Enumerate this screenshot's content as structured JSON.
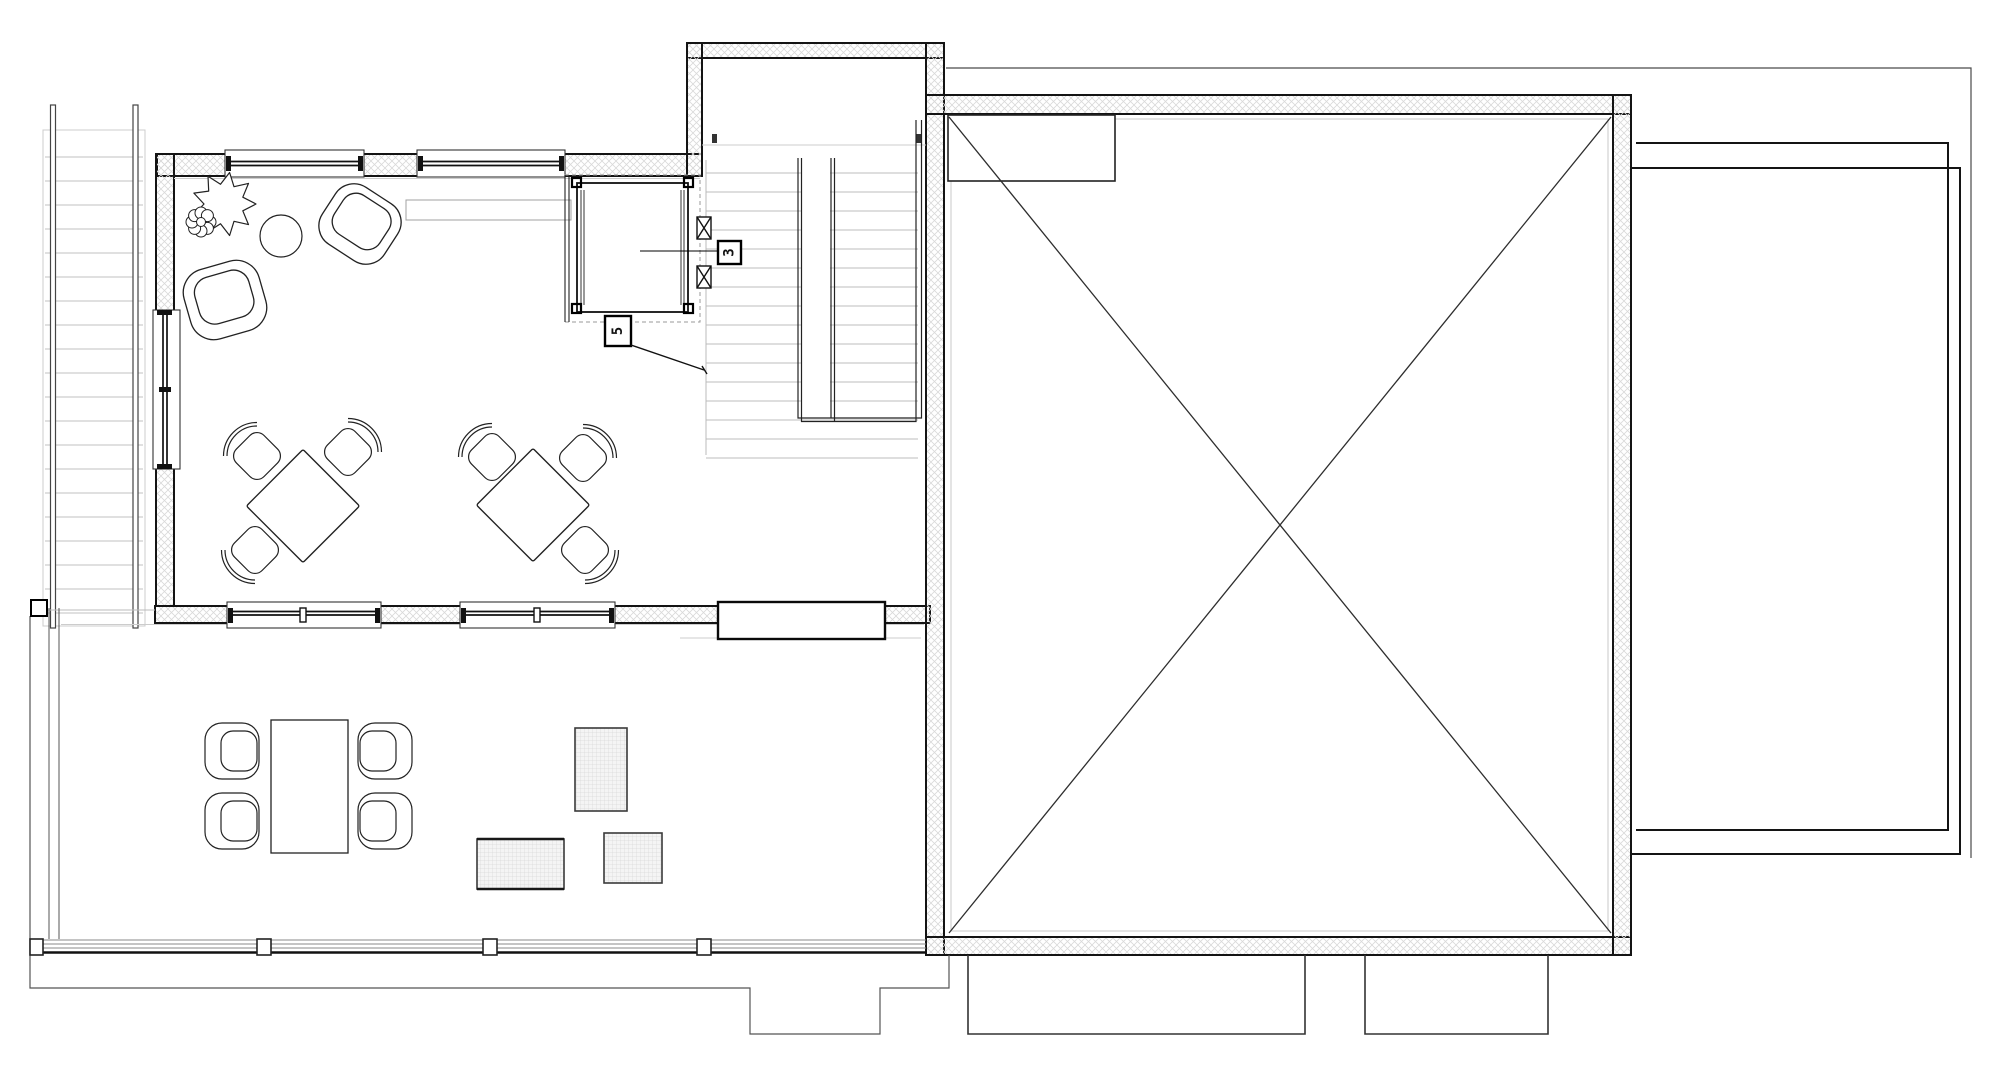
{
  "elevator": {
    "label_3": "3",
    "label_5": "5"
  },
  "colors": {
    "background": "#ffffff",
    "wall_edge": "#141414",
    "wall_hatch_line": "#d9d9d9",
    "stair_tread": "#cccccc",
    "thin_outline": "#555555",
    "furniture_line": "#222222",
    "mat_grid_line": "#d8d8d8"
  }
}
